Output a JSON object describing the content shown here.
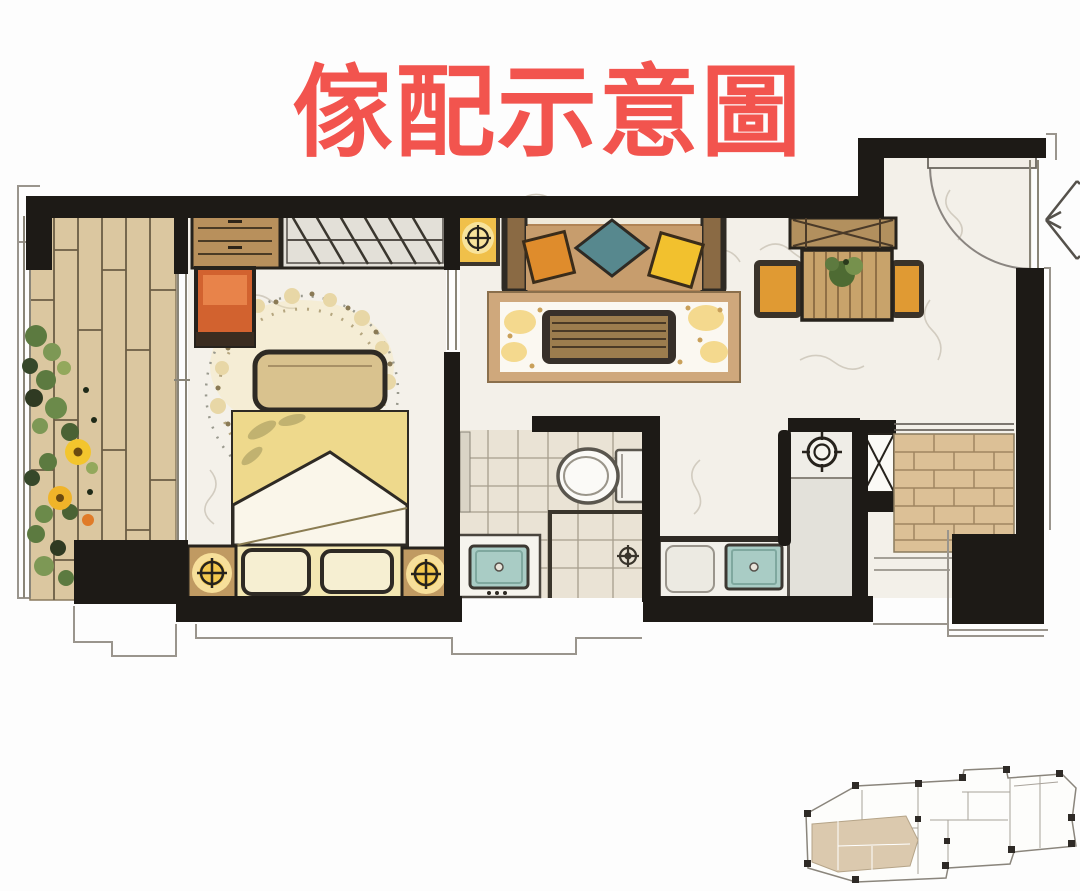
{
  "title": {
    "text": "傢配示意圖",
    "color": "#f2544e"
  },
  "palette": {
    "wall_black": "#1d1a16",
    "marble_floor": "#f3f0e9",
    "balcony_wood": "#dbc7a0",
    "bathroom_tile": "#eae3d5",
    "service_brick": "#dcc096",
    "rug_border": "#cfa87c",
    "bed_quilt": "#eed98c",
    "cabinet_orange": "#d2622f",
    "cushion_orange": "#df8c2c",
    "cushion_teal": "#57888e",
    "cushion_yellow": "#f2c12e",
    "lamp_glow": "#f3c84f",
    "sink_teal": "#a9ccc5",
    "plant_green": "#5c7a40",
    "flower_yellow": "#f3c52d",
    "keyplan_highlight": "#dbc9ae"
  }
}
